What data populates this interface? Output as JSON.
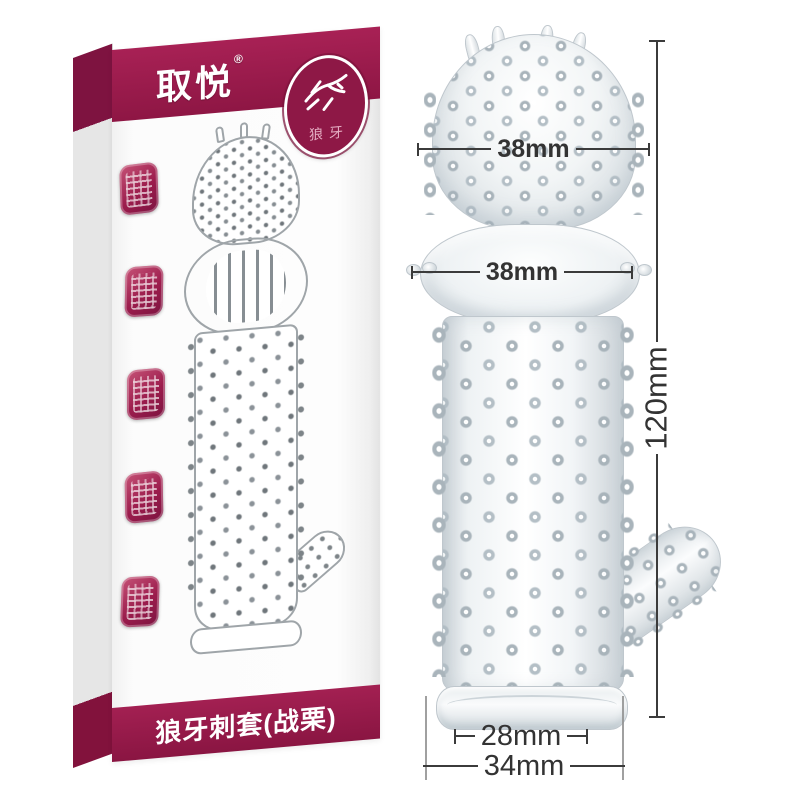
{
  "box": {
    "brand": "取悦",
    "reg_mark": "®",
    "badge": {
      "icon": "wolf-icon",
      "label": "狼牙"
    },
    "stamps": [
      {
        "icon": "seal-stamp-icon"
      },
      {
        "icon": "seal-stamp-icon"
      },
      {
        "icon": "seal-stamp-icon"
      },
      {
        "icon": "seal-stamp-icon"
      },
      {
        "icon": "seal-stamp-icon"
      }
    ],
    "title": "狼牙刺套(战栗)"
  },
  "annotations": {
    "head_width": "38mm",
    "ring_width": "38mm",
    "total_length": "120mm",
    "base_inner_width": "28mm",
    "base_outer_width": "34mm"
  },
  "colors": {
    "maroon": "#9c1d4d",
    "maroon_dark": "#7e1340",
    "maroon_deep": "#8e1846",
    "dim_line": "#3b3b3b",
    "glass_edge": "#bfc7cd"
  }
}
